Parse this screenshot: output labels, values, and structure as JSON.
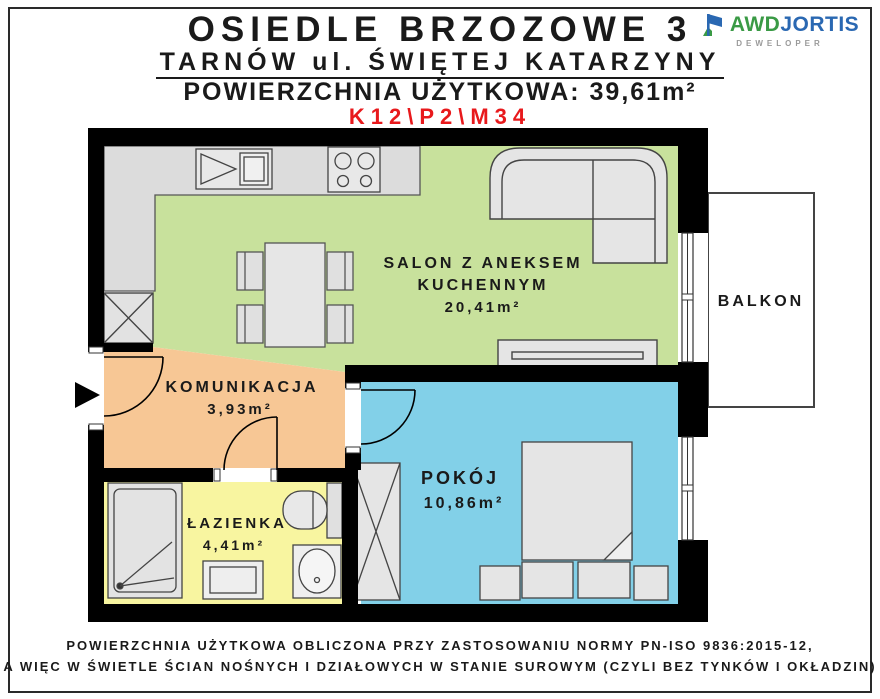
{
  "header": {
    "title": "OSIEDLE BRZOZOWE 3",
    "subtitle": "TARNÓW ul. ŚWIĘTEJ KATARZYNY",
    "area_line": "POWIERZCHNIA UŻYTKOWA: 39,61m²",
    "unit_code": "K12\\P2\\M34"
  },
  "logo": {
    "name_part1": "AWD",
    "name_part2": "JORTIS",
    "tagline": "DEWELOPER"
  },
  "rooms": {
    "salon": {
      "name_line1": "SALON Z ANEKSEM",
      "name_line2": "KUCHENNYM",
      "area": "20,41m²"
    },
    "komunikacja": {
      "name": "KOMUNIKACJA",
      "area": "3,93m²"
    },
    "lazienka": {
      "name": "ŁAZIENKA",
      "area": "4,41m²"
    },
    "pokoj": {
      "name": "POKÓJ",
      "area": "10,86m²"
    },
    "balkon": {
      "name": "BALKON"
    }
  },
  "footer": {
    "line1": "POWIERZCHNIA UŻYTKOWA OBLICZONA PRZY ZASTOSOWANIU NORMY PN-ISO 9836:2015-12,",
    "line2": "A WIĘC W ŚWIETLE ŚCIAN NOŚNYCH I DZIAŁOWYCH W STANIE SUROWYM (CZYLI BEZ TYNKÓW I OKŁADZIN)"
  },
  "colors": {
    "salon": "#c8e19c",
    "komunikacja": "#f7c795",
    "lazienka": "#f8f5a0",
    "pokoj": "#82d0e8",
    "balkon": "#ffffff",
    "unit_code_red": "#e8191c",
    "logo_green": "#3a9a45",
    "logo_blue": "#2a68b2",
    "wall": "#000000"
  }
}
